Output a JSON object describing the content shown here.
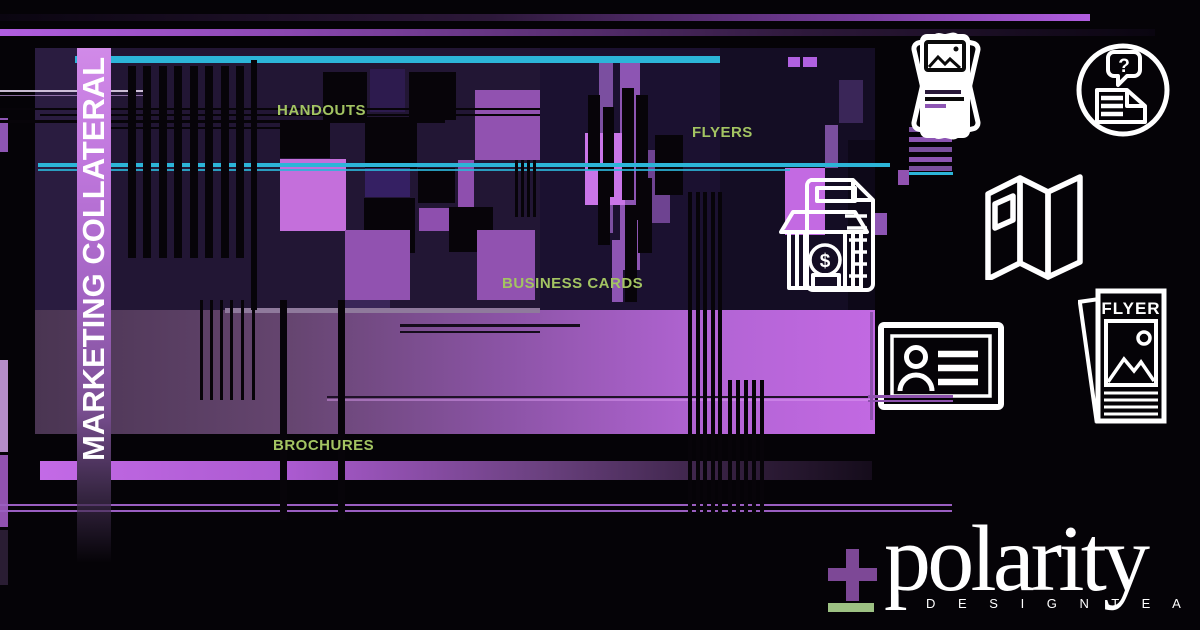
{
  "title": "MARKETING COLLATERAL",
  "labels": {
    "handouts": "HANDOUTS",
    "flyers": "FLYERS",
    "business_cards": "BUSINESS CARDS",
    "brochures": "BROCHURES"
  },
  "icons": {
    "flyer_stack": "handout-cards-icon",
    "faq_circle": "question-document-icon",
    "faq_glyph": "?",
    "trifold": "trifold-brochure-icon",
    "storefront": "storefront-invoice-icon",
    "storefront_glyph": "$",
    "business_card": "business-card-icon",
    "flyer": "flyer-icon",
    "flyer_label": "FLYER"
  },
  "logo": {
    "plus": "+",
    "name": "polarity",
    "subtitle": "D E S I G N   T E A M",
    "plus_color": "#7d4896",
    "underline_color": "#9dc183"
  },
  "colors": {
    "background": "#050307",
    "panel": "#221634",
    "cyan": "#2cb5d8",
    "label_green": "#a3c462",
    "purple_bright": "#c46fdb",
    "purple_mid": "#9152b0",
    "indigo": "#352063"
  },
  "artwork": {
    "under": [
      [
        35,
        48,
        840,
        262,
        "#221634"
      ],
      [
        35,
        48,
        42,
        262,
        "#2a1c40"
      ],
      [
        540,
        48,
        180,
        262,
        "#1b1130"
      ],
      [
        720,
        48,
        155,
        262,
        "#140d24"
      ],
      [
        848,
        140,
        27,
        170,
        "#0d0818"
      ],
      [
        280,
        122,
        50,
        36,
        "#070409"
      ],
      [
        323,
        72,
        44,
        50,
        "#070409"
      ],
      [
        370,
        69,
        35,
        43,
        "#2d1b4e"
      ],
      [
        409,
        72,
        47,
        48,
        "#070409"
      ],
      [
        475,
        90,
        65,
        70,
        "#9152b0"
      ],
      [
        365,
        117,
        52,
        53,
        "#070409"
      ],
      [
        280,
        159,
        66,
        72,
        "#c46fdb"
      ],
      [
        365,
        168,
        45,
        29,
        "#352063"
      ],
      [
        418,
        168,
        37,
        35,
        "#070409"
      ],
      [
        458,
        160,
        16,
        47,
        "#8e4fae"
      ],
      [
        449,
        207,
        44,
        45,
        "#070409"
      ],
      [
        419,
        208,
        30,
        23,
        "#8e4fae"
      ],
      [
        364,
        198,
        51,
        55,
        "#070409"
      ],
      [
        345,
        230,
        65,
        70,
        "#9152b0"
      ],
      [
        477,
        230,
        58,
        70,
        "#9152b0"
      ],
      [
        345,
        300,
        45,
        33,
        "#3a2658"
      ],
      [
        599,
        63,
        14,
        170,
        "#7b4fa0"
      ],
      [
        620,
        63,
        20,
        207,
        "#8d55b3"
      ],
      [
        648,
        150,
        22,
        73,
        "#6e4391"
      ],
      [
        585,
        133,
        40,
        72,
        "#c975e8"
      ],
      [
        588,
        95,
        12,
        75,
        "#070409"
      ],
      [
        603,
        107,
        11,
        90,
        "#070409"
      ],
      [
        622,
        88,
        12,
        112,
        "#070409"
      ],
      [
        636,
        95,
        12,
        125,
        "#070409"
      ],
      [
        612,
        240,
        11,
        62,
        "#8d55b3"
      ],
      [
        598,
        165,
        12,
        80,
        "#070409"
      ],
      [
        625,
        205,
        12,
        97,
        "#070409"
      ],
      [
        638,
        178,
        14,
        75,
        "#070409"
      ],
      [
        655,
        135,
        28,
        60,
        "#070409"
      ],
      [
        788,
        57,
        12,
        10,
        "#b060e0"
      ],
      [
        803,
        57,
        14,
        10,
        "#b060e0"
      ],
      [
        839,
        80,
        24,
        43,
        "#3a2658"
      ],
      [
        825,
        125,
        13,
        43,
        "#7a4f9e"
      ],
      [
        785,
        168,
        40,
        67,
        "#c36ae2"
      ],
      [
        872,
        213,
        15,
        22,
        "#8d55b3"
      ],
      [
        909,
        127,
        43,
        5,
        "#7a4f9e"
      ],
      [
        909,
        137,
        43,
        5,
        "#8d55b3"
      ],
      [
        909,
        147,
        43,
        5,
        "#7a4f9e"
      ],
      [
        909,
        157,
        43,
        5,
        "#8d55b3"
      ],
      [
        909,
        166,
        43,
        5,
        "#7a4f9e"
      ],
      [
        898,
        170,
        11,
        15,
        "#9152b0"
      ],
      [
        909,
        172,
        44,
        3,
        "#2cb5d8"
      ],
      [
        0,
        118,
        8,
        34,
        "#8d55b3"
      ],
      [
        0,
        360,
        8,
        92,
        "#b48cc8"
      ],
      [
        0,
        455,
        8,
        72,
        "#9152b0"
      ],
      [
        0,
        530,
        8,
        55,
        "#2a1d33"
      ]
    ],
    "over": [
      [
        225,
        308,
        315,
        5,
        "#8f7a9c"
      ],
      [
        327,
        396,
        548,
        2,
        "#1f1228"
      ],
      [
        327,
        399,
        548,
        2,
        "rgba(225,160,245,0.45)"
      ],
      [
        400,
        324,
        180,
        3,
        "#150c1c"
      ],
      [
        400,
        331,
        140,
        2,
        "#150c1c"
      ],
      [
        0,
        90,
        150,
        2,
        "rgba(235,220,245,0.85)"
      ],
      [
        0,
        95,
        150,
        1,
        "rgba(190,150,215,0.7)"
      ],
      [
        0,
        108,
        540,
        2,
        "#070409"
      ],
      [
        40,
        114,
        500,
        2,
        "#070409"
      ],
      [
        0,
        120,
        445,
        3,
        "#070409"
      ],
      [
        85,
        127,
        230,
        2,
        "#070409"
      ],
      [
        128,
        66,
        8,
        192,
        "#070409"
      ],
      [
        143,
        66,
        8,
        192,
        "#070409"
      ],
      [
        159,
        66,
        8,
        192,
        "#070409"
      ],
      [
        174,
        66,
        8,
        192,
        "#070409"
      ],
      [
        190,
        66,
        8,
        192,
        "#070409"
      ],
      [
        205,
        66,
        8,
        192,
        "#070409"
      ],
      [
        221,
        66,
        8,
        192,
        "#070409"
      ],
      [
        236,
        66,
        8,
        192,
        "#070409"
      ],
      [
        251,
        60,
        6,
        250,
        "#070409"
      ],
      [
        200,
        300,
        3,
        100,
        "#070409"
      ],
      [
        210,
        300,
        3,
        100,
        "#070409"
      ],
      [
        220,
        300,
        3,
        100,
        "#070409"
      ],
      [
        230,
        300,
        3,
        100,
        "#070409"
      ],
      [
        241,
        300,
        3,
        100,
        "#070409"
      ],
      [
        252,
        300,
        3,
        100,
        "#070409"
      ],
      [
        280,
        300,
        7,
        220,
        "#070409"
      ],
      [
        338,
        300,
        7,
        220,
        "#070409"
      ],
      [
        688,
        192,
        4,
        323,
        "#070409"
      ],
      [
        696,
        192,
        4,
        323,
        "#070409"
      ],
      [
        703,
        192,
        4,
        323,
        "#070409"
      ],
      [
        711,
        192,
        4,
        323,
        "#070409"
      ],
      [
        718,
        192,
        4,
        323,
        "#070409"
      ],
      [
        728,
        380,
        4,
        135,
        "#070409"
      ],
      [
        736,
        380,
        4,
        135,
        "#070409"
      ],
      [
        744,
        380,
        4,
        135,
        "#070409"
      ],
      [
        752,
        380,
        4,
        135,
        "#070409"
      ],
      [
        760,
        380,
        4,
        135,
        "#070409"
      ],
      [
        515,
        160,
        3,
        57,
        "#070409"
      ],
      [
        521,
        160,
        3,
        57,
        "#070409"
      ],
      [
        527,
        160,
        3,
        57,
        "#070409"
      ],
      [
        533,
        160,
        3,
        57,
        "#070409"
      ]
    ],
    "top": [
      [
        868,
        395,
        85,
        3,
        "#8d52ad"
      ],
      [
        868,
        400,
        85,
        2,
        "#8d52ad"
      ],
      [
        870,
        312,
        3,
        108,
        "#8d52ad"
      ]
    ]
  }
}
